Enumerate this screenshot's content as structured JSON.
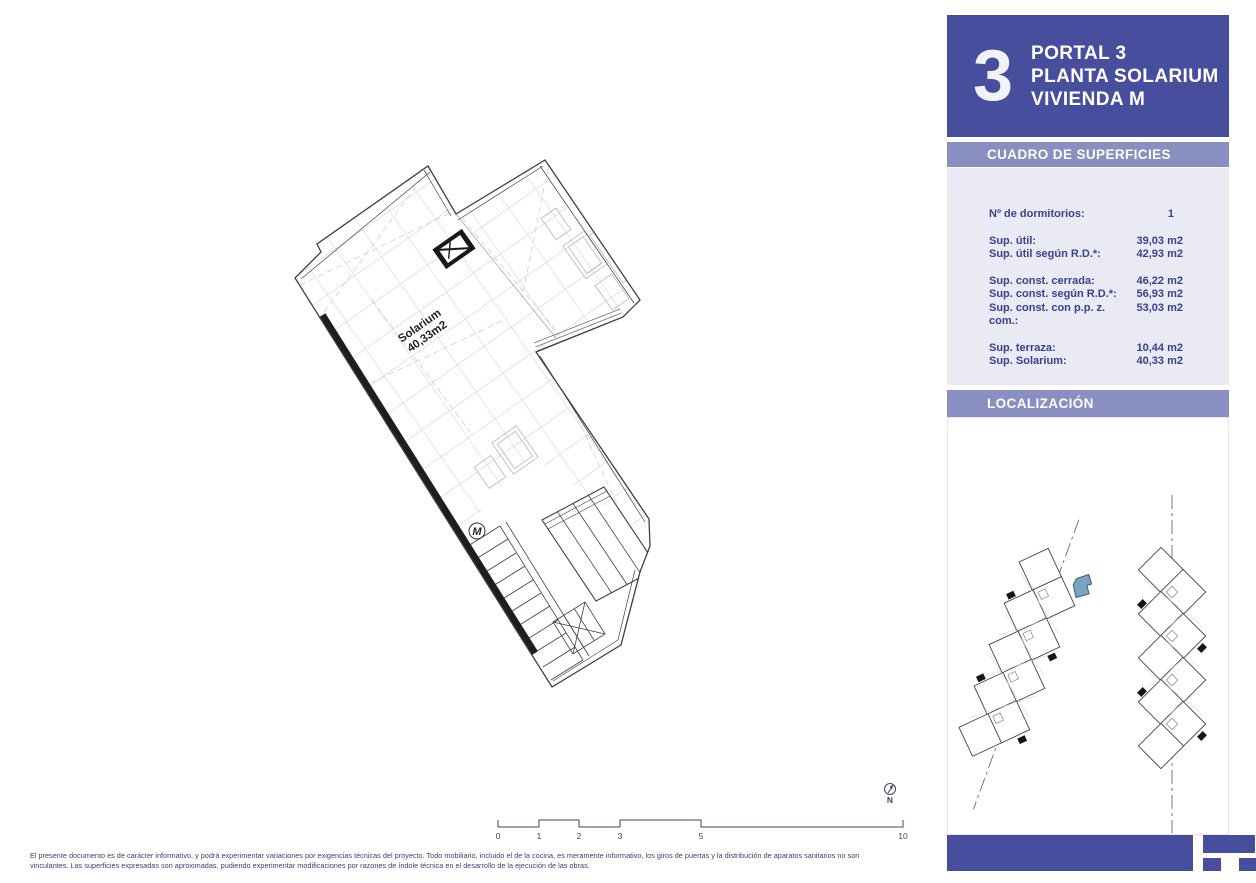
{
  "document_title": "Portal 3 - Planta Solarium - Vivienda M",
  "colors": {
    "accent_purple": "#484e9e",
    "band_purple": "#8a8fc2",
    "panel_bg": "#e9eaf4",
    "table_text": "#3a4090",
    "highlight_blue": "#7ba3bd"
  },
  "header": {
    "portal_number": "3",
    "title_line1": "PORTAL 3",
    "title_line2": "PLANTA SOLARIUM",
    "title_line3": "VIVIENDA M"
  },
  "surfaces": {
    "title": "CUADRO DE SUPERFICIES",
    "rows": [
      {
        "label": "Nº de dormitorios:",
        "value": "1"
      },
      {
        "label": "Sup. útil:",
        "value": "39,03 m2"
      },
      {
        "label": "Sup. útil según R.D.*:",
        "value": "42,93 m2"
      },
      {
        "label": "Sup. const. cerrada:",
        "value": "46,22 m2"
      },
      {
        "label": "Sup. const. según R.D.*:",
        "value": "56,93 m2"
      },
      {
        "label": "Sup. const. con p.p. z. com.:",
        "value": "53,03 m2"
      },
      {
        "label": "Sup. terraza:",
        "value": "10,44 m2"
      },
      {
        "label": "Sup. Solarium:",
        "value": "40,33 m2"
      }
    ]
  },
  "localization": {
    "title": "LOCALIZACIÓN"
  },
  "plan": {
    "room_label": "Solarium",
    "room_area": "40,33m2",
    "unit_letter": "M"
  },
  "scale_bar": {
    "labels": [
      "0",
      "1",
      "2",
      "3",
      "5",
      "10"
    ]
  },
  "north_indicator": {
    "label": "N"
  },
  "disclaimer": {
    "line1": "El presente documento es de carácter informativo, y podrá experimentar variaciones por exigencias técnicas del proyecto. Todo mobiliario, incluido el de la cocina, es meramente informativo, los giros de puertas y la distribución de aparatos sanitarios no son",
    "line2": "vinculantes. Las superficies expresadas son aproximadas, pudiendo experimentar modificaciones por razones de índole técnica en el desarrollo de la ejecución de las obras."
  }
}
